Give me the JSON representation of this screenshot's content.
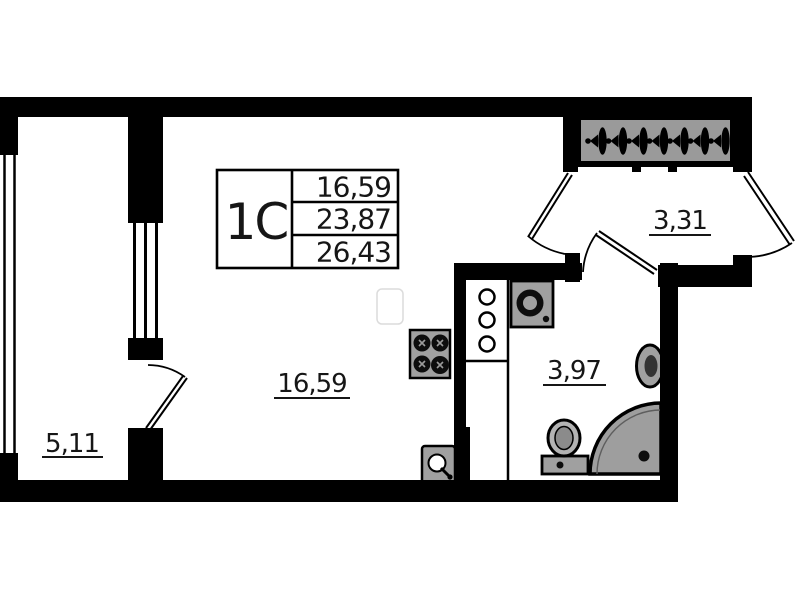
{
  "unit_info_box": {
    "unit_label": "1С",
    "values": [
      "16,59",
      "23,87",
      "26,43"
    ]
  },
  "room_labels": {
    "living_room": "16,59",
    "balcony": "5,11",
    "bathroom": "3,97",
    "hallway": "3,31"
  },
  "icons": [
    "stove-icon",
    "kitchen-sink-icon",
    "vent-shaft-icon",
    "washing-machine-icon",
    "toilet-icon",
    "washbasin-icon",
    "shower-icon",
    "hanger-icon",
    "balcony-door",
    "living-room-door",
    "bathroom-door",
    "entrance-door",
    "balcony-outer-window",
    "balcony-inner-window"
  ],
  "colors": {
    "wall": "#000000",
    "fixture_gray": "#a0a0a0",
    "wardrobe_gray": "#9a9a9a",
    "shower_gray": "#9e9e9e",
    "label_text": "#161616",
    "background": "#ffffff"
  }
}
